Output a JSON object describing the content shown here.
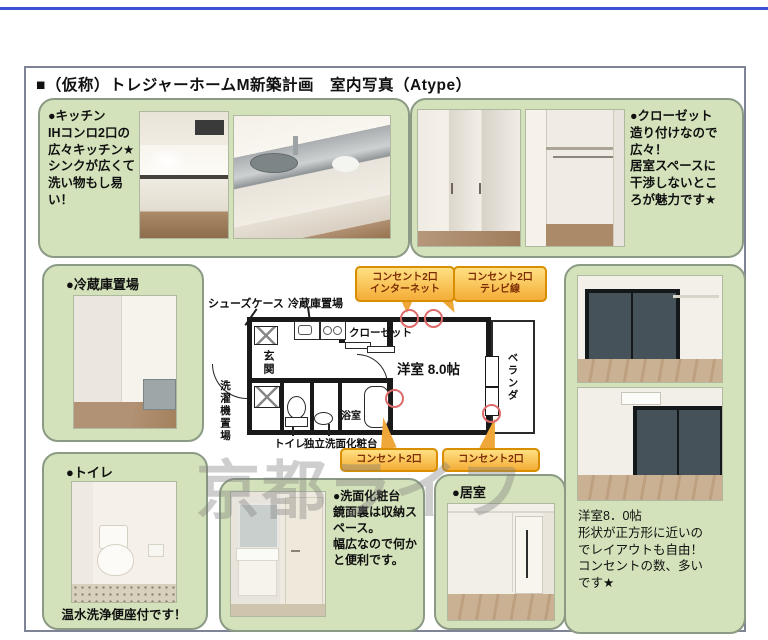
{
  "header": {
    "title": "■（仮称）トレジャーホームM新築計画　室内写真（Atype）"
  },
  "panels": {
    "kitchen": {
      "text": "●キッチン\nIHコンロ2口の\n広々キッチン★\nシンクが広くて\n洗い物もし易\nい！"
    },
    "closet": {
      "text": "●クローゼット\n造り付けなので\n広々！\n居室スペースに\n干渉しないとこ\nろが魅力です★"
    },
    "fridge": {
      "label": "●冷蔵庫置場"
    },
    "toilet": {
      "label": "●トイレ",
      "caption": "温水洗浄便座付です！"
    },
    "washbasin": {
      "text": "●洗面化粧台\n鏡面裏は収納ス\nペース。\n幅広なので何か\nと便利です。"
    },
    "living": {
      "label": "●居室"
    },
    "room_note": {
      "text": "洋室8．0帖\n形状が正方形に近いの\nでレイアウトも自由！\nコンセントの数、多い\nです★"
    }
  },
  "floorplan": {
    "labels": {
      "shoes": "シューズケース",
      "fridge_spot": "冷蔵庫置場",
      "closet": "クローゼット",
      "room": "洋室 8.0帖",
      "veranda": "ベランダ",
      "entrance": "玄関",
      "washer": "洗濯機置場",
      "toilet": "トイレ",
      "vanity": "独立洗面化粧台",
      "bath": "浴室"
    },
    "callouts": {
      "internet": "コンセント2口\nインターネット",
      "tv": "コンセント2口\nテレビ線",
      "outlet_left": "コンセント2口",
      "outlet_right": "コンセント2口"
    }
  },
  "watermark": "京都ライフ",
  "colors": {
    "panel_green": "#d3e2ba",
    "panel_border": "#8b9a84",
    "callout_yellow": "#f4ad38",
    "callout_border": "#d98e00",
    "accent_blue": "#3b52d4",
    "circle_red": "#dd6b6b"
  }
}
